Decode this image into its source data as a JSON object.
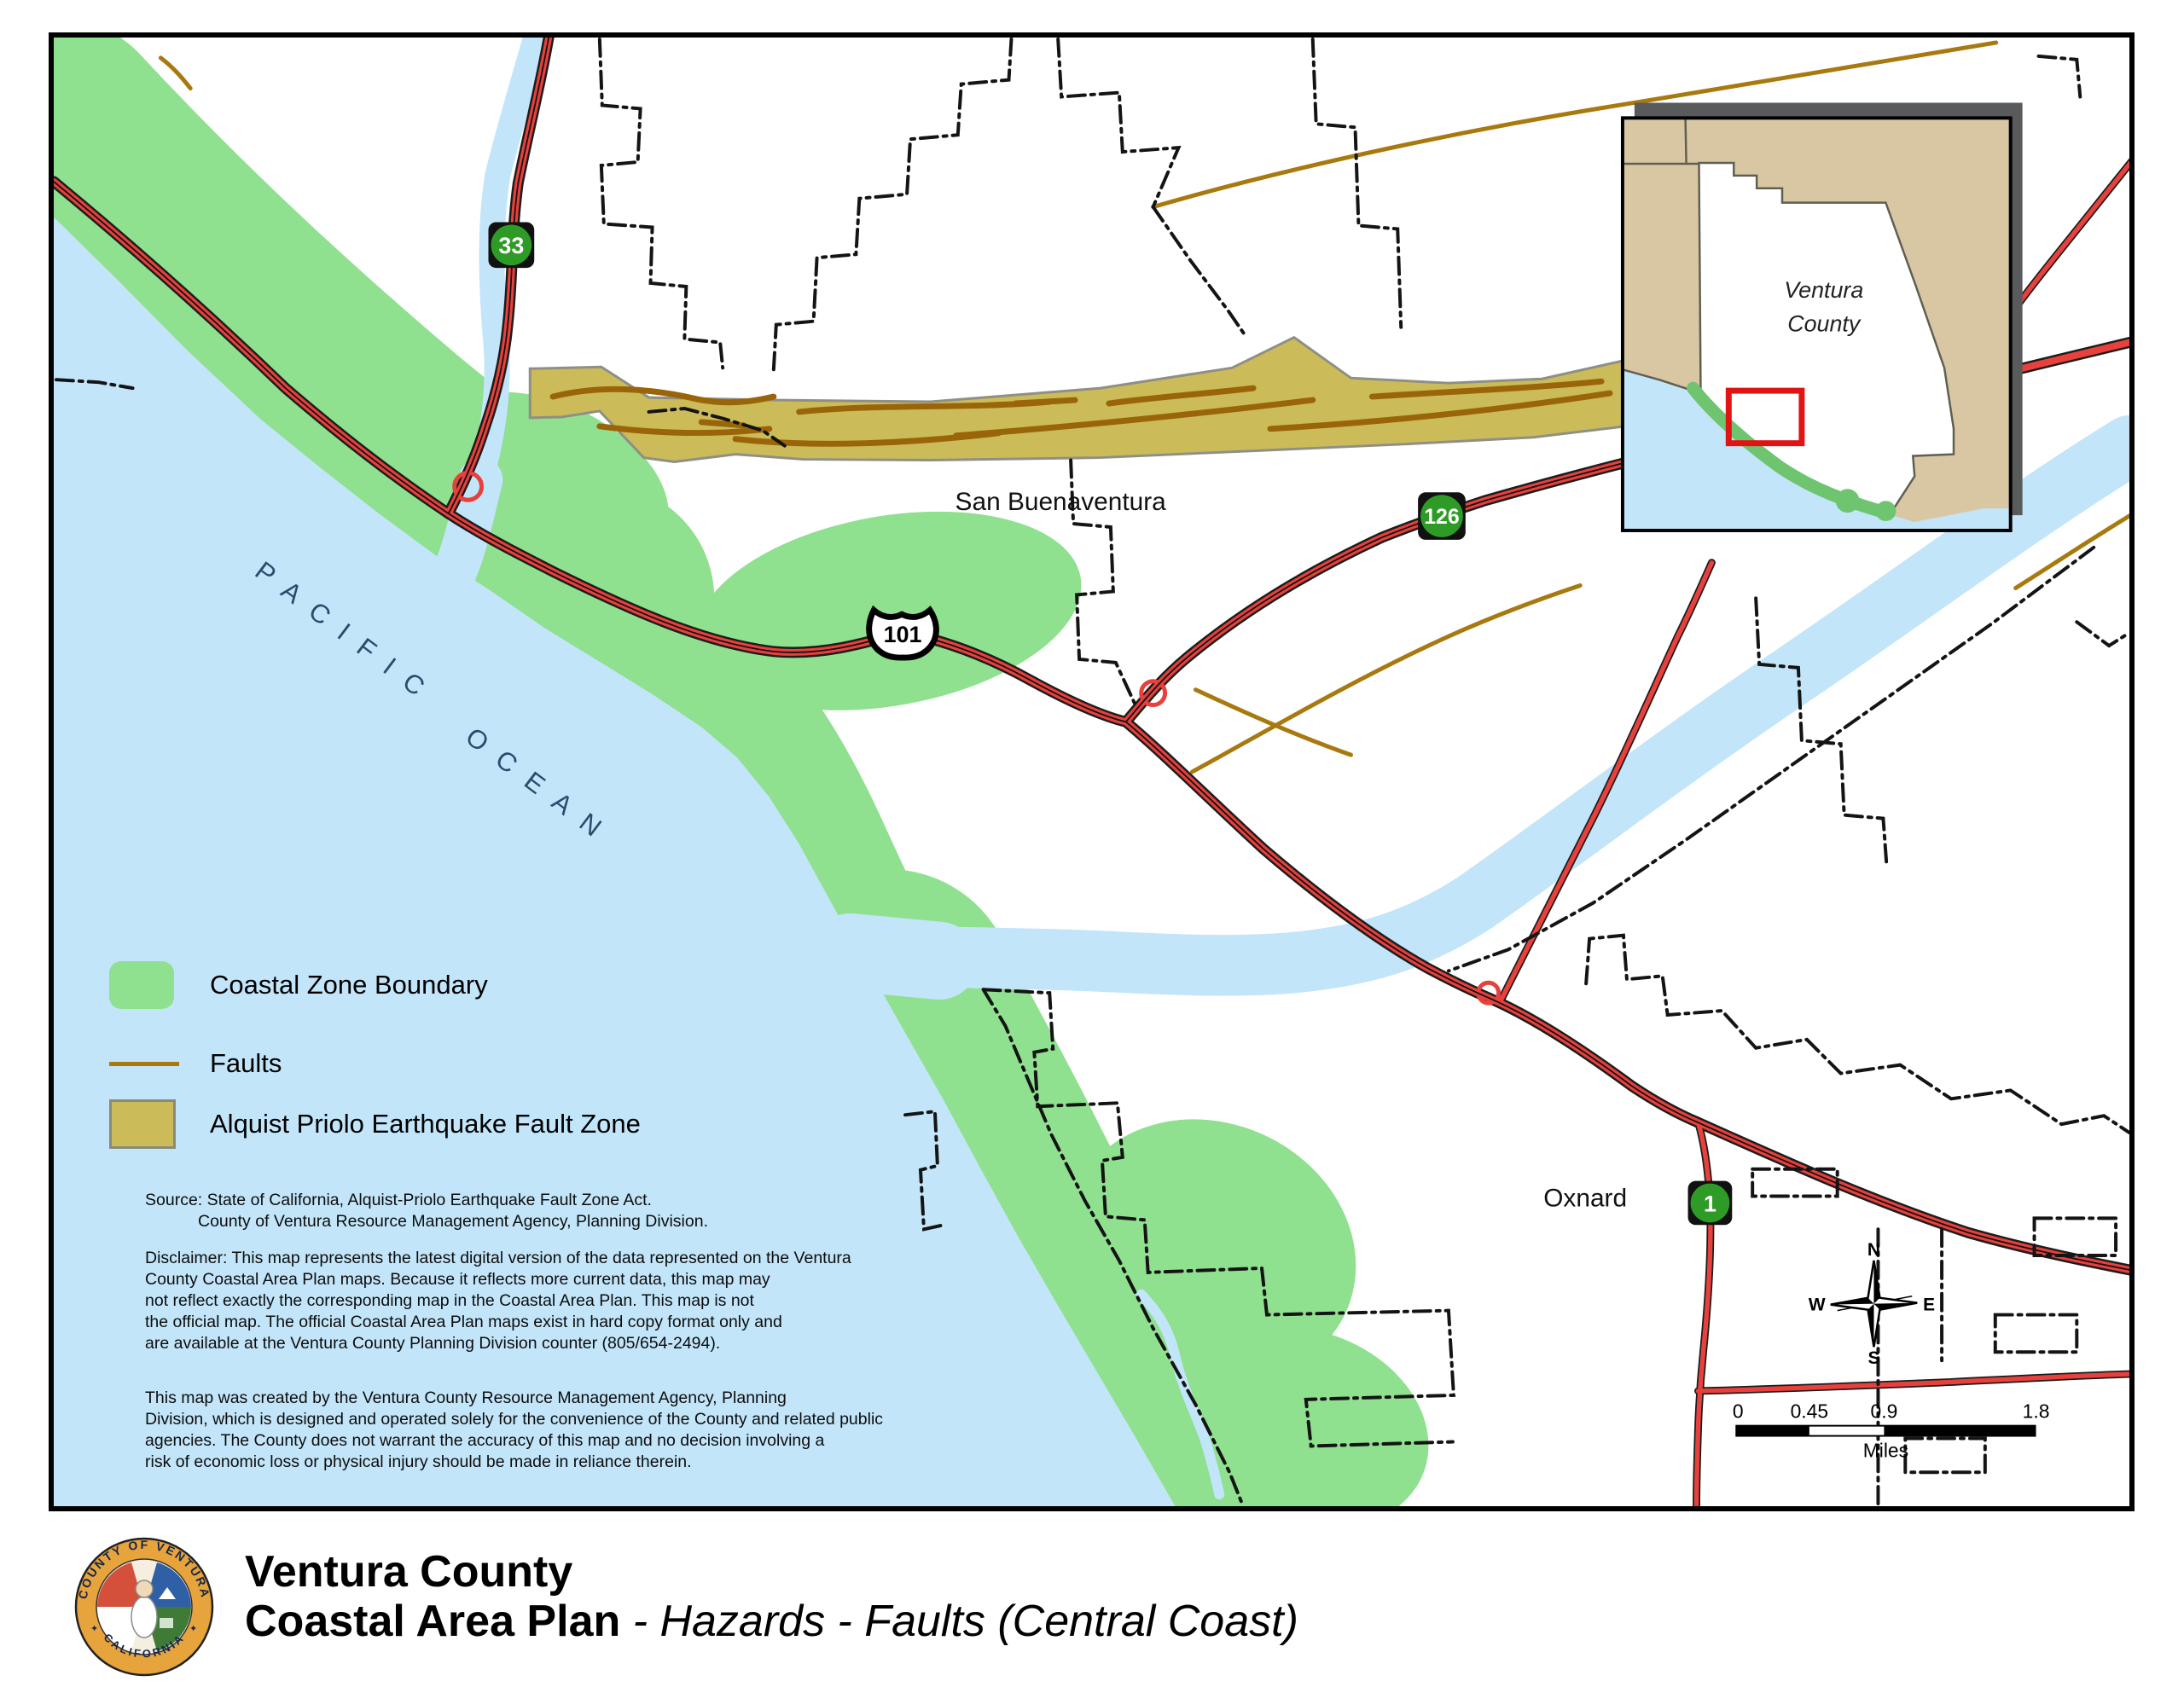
{
  "colors": {
    "ocean": "#C2E5F9",
    "coastal_zone_green": "#8FE08F",
    "ap_zone_olive": "#CBBC59",
    "ap_zone_border": "#8f8f85",
    "fault_brown": "#A8790F",
    "fault_dark_brown": "#9A6508",
    "road_red": "#E8403C",
    "shield_green": "#2F9B27",
    "inset_tan": "#D9C7A4",
    "ocean_label_blue": "#2C4A6E"
  },
  "map": {
    "ocean_label_word1": "PACIFIC",
    "ocean_label_word2": "OCEAN",
    "cities": {
      "san_buenaventura": "San Buenaventura",
      "oxnard": "Oxnard"
    },
    "route_shields": {
      "route_33": "33",
      "route_101": "101",
      "route_126": "126",
      "route_1": "1"
    }
  },
  "inset_map": {
    "label_line1": "Ventura",
    "label_line2": "County"
  },
  "legend": {
    "items": [
      {
        "label": "Coastal Zone Boundary"
      },
      {
        "label": "Faults"
      },
      {
        "label": "Alquist Priolo Earthquake Fault Zone"
      }
    ]
  },
  "notes": {
    "source_lines": [
      "Source: State of California, Alquist-Priolo Earthquake Fault Zone Act.",
      "County of Ventura Resource Management Agency, Planning Division."
    ],
    "disclaimer_lines": [
      "Disclaimer: This map represents the latest digital version of the data represented on the Ventura",
      "County Coastal Area Plan maps. Because it reflects more current data, this map may",
      "not reflect exactly the corresponding map in the Coastal Area Plan. This map is not",
      "the official map. The official Coastal Area Plan maps exist in hard copy format only and",
      "are available at the Ventura County Planning Division counter (805/654-2494)."
    ],
    "created_lines": [
      "This map was created by the Ventura County Resource Management Agency, Planning",
      "Division, which is designed and operated solely for the convenience of the County and related public",
      "agencies.  The County does not warrant the accuracy of this map and no decision involving a",
      "risk of economic loss or physical injury should be made in reliance therein."
    ]
  },
  "scale_bar": {
    "ticks": [
      "0",
      "0.45",
      "0.9",
      "1.8"
    ],
    "unit": "Miles"
  },
  "compass": {
    "north": "N",
    "south": "S",
    "east": "E",
    "west": "W"
  },
  "title_block": {
    "line1": "Ventura County",
    "line2_bold": "Coastal Area Plan",
    "line2_italic": " - Hazards - Faults (Central Coast)"
  },
  "seal": {
    "ring_top": "COUNTY OF VENTURA",
    "ring_bottom": "CALIFORNIA",
    "star": "✦"
  }
}
